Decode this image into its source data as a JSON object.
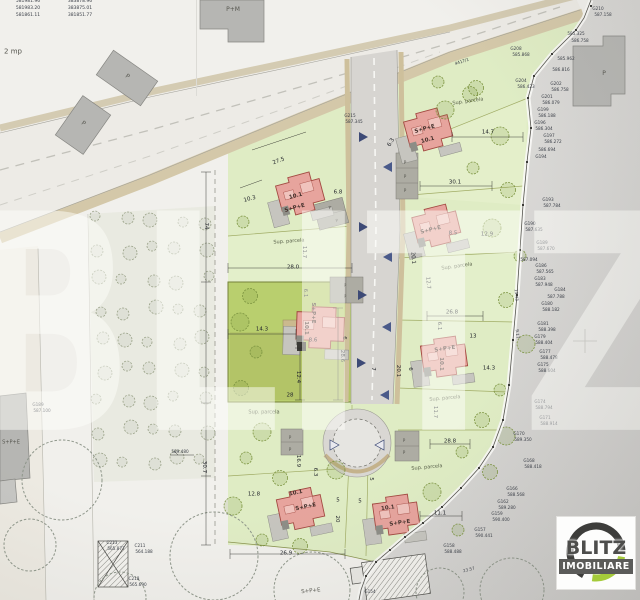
{
  "watermark": {
    "text": "BLITZ"
  },
  "logo": {
    "line1": "BLITZ",
    "line2": "IMOBILIARE",
    "ring_dark": "#3d3d3b",
    "ring_green": "#a5cb3a"
  },
  "colors": {
    "parcel_green": "#dfecc4",
    "selected_parcel": "#b9cf6e",
    "house_pink": "#e7a49d",
    "house_outline": "#a34a42",
    "road_gray": "#d7d5d1",
    "shoulder_tan": "#d4c8a9",
    "blank_gray": "#d5d4d1",
    "arrow_navy": "#3d4a76"
  },
  "labels": [
    {
      "t": "581981.96",
      "x": 28,
      "y": 2,
      "s": 4.5,
      "c": "t"
    },
    {
      "t": "581983.20",
      "x": 28,
      "y": 9,
      "s": 4.5,
      "c": "t"
    },
    {
      "t": "581861.11",
      "x": 28,
      "y": 16,
      "s": 4.5,
      "c": "t"
    },
    {
      "t": "383878.96",
      "x": 80,
      "y": 2,
      "s": 4.5,
      "c": "t"
    },
    {
      "t": "383875.01",
      "x": 80,
      "y": 9,
      "s": 4.5,
      "c": "t"
    },
    {
      "t": "381851.77",
      "x": 80,
      "y": 16,
      "s": 4.5,
      "c": "t"
    },
    {
      "t": "2 mp",
      "x": 13,
      "y": 52,
      "s": 7,
      "c": "g"
    },
    {
      "t": "P+M",
      "x": 233,
      "y": 10,
      "s": 6,
      "c": "g"
    },
    {
      "t": "P",
      "x": 127,
      "y": 77,
      "s": 6,
      "c": "g",
      "r": 35
    },
    {
      "t": "P",
      "x": 83,
      "y": 124,
      "s": 6,
      "c": "g",
      "r": 35
    },
    {
      "t": "P",
      "x": 604,
      "y": 74,
      "s": 6,
      "c": "g"
    },
    {
      "t": "S+P+E",
      "x": 11,
      "y": 443,
      "s": 5,
      "c": "g"
    },
    {
      "t": "S+P+E",
      "x": 311,
      "y": 592,
      "s": 5.5,
      "c": "g",
      "r": -6
    },
    {
      "t": "4417/1",
      "x": 462,
      "y": 62,
      "s": 4.2,
      "c": "t",
      "r": -18
    },
    {
      "t": "G215",
      "x": 350,
      "y": 116,
      "s": 4.2,
      "c": "t"
    },
    {
      "t": "587.345",
      "x": 354,
      "y": 122,
      "s": 4.2,
      "c": "t"
    },
    {
      "t": "10.1",
      "x": 296,
      "y": 197,
      "s": 5.5,
      "c": "h",
      "r": -15
    },
    {
      "t": "S+P+E",
      "x": 295,
      "y": 209,
      "s": 5.5,
      "c": "h",
      "r": -15
    },
    {
      "t": "S+P+E",
      "x": 425,
      "y": 130,
      "s": 5.5,
      "c": "h",
      "r": -15
    },
    {
      "t": "10.1",
      "x": 428,
      "y": 141,
      "s": 5.5,
      "c": "h",
      "r": -15
    },
    {
      "t": "S+P+E",
      "x": 431,
      "y": 231,
      "s": 5.5,
      "c": "h",
      "r": -14
    },
    {
      "t": "8.5",
      "x": 453,
      "y": 234,
      "s": 5.5,
      "c": "d"
    },
    {
      "t": "S+P+E",
      "x": 312,
      "y": 313,
      "s": 5.5,
      "c": "h",
      "r": 90
    },
    {
      "t": "10.1",
      "x": 305,
      "y": 328,
      "s": 5.5,
      "c": "h",
      "r": 90
    },
    {
      "t": "8.6",
      "x": 313,
      "y": 341,
      "s": 5.5,
      "c": "d"
    },
    {
      "t": "S+P+E",
      "x": 445,
      "y": 350,
      "s": 5.5,
      "c": "h",
      "r": -8
    },
    {
      "t": "10.1",
      "x": 440,
      "y": 364,
      "s": 5.5,
      "c": "h",
      "r": 90
    },
    {
      "t": "10.1",
      "x": 296,
      "y": 494,
      "s": 5.5,
      "c": "h",
      "r": -12
    },
    {
      "t": "S+P+E",
      "x": 306,
      "y": 508,
      "s": 5.5,
      "c": "h",
      "r": -12
    },
    {
      "t": "10.1",
      "x": 388,
      "y": 509,
      "s": 5.5,
      "c": "h",
      "r": -8
    },
    {
      "t": "S+P+E",
      "x": 400,
      "y": 524,
      "s": 5.5,
      "c": "h",
      "r": -8
    },
    {
      "t": "Sup. parcela",
      "x": 289,
      "y": 242,
      "s": 5,
      "c": "p",
      "r": -4
    },
    {
      "t": "Sup. parcela",
      "x": 264,
      "y": 413,
      "s": 5,
      "c": "p"
    },
    {
      "t": "Sup. parcela",
      "x": 468,
      "y": 102,
      "s": 5,
      "c": "p",
      "r": -8
    },
    {
      "t": "Sup. parcela",
      "x": 457,
      "y": 267,
      "s": 5,
      "c": "p",
      "r": -8
    },
    {
      "t": "Sup. parcela",
      "x": 445,
      "y": 399,
      "s": 5,
      "c": "p",
      "r": -5
    },
    {
      "t": "Sup. parcela",
      "x": 427,
      "y": 468,
      "s": 5,
      "c": "p",
      "r": -5
    },
    {
      "t": "27.5",
      "x": 279,
      "y": 162,
      "c": "d",
      "r": -20,
      "s": 5.5
    },
    {
      "t": "10.3",
      "x": 250,
      "y": 200,
      "c": "d",
      "r": -15,
      "s": 5.5
    },
    {
      "t": "6.8",
      "x": 338,
      "y": 193,
      "c": "d",
      "s": 5.5
    },
    {
      "t": "11.7",
      "x": 303,
      "y": 252,
      "c": "d",
      "r": 90,
      "s": 5.5
    },
    {
      "t": "28.0",
      "x": 293,
      "y": 268,
      "c": "d",
      "s": 5.5
    },
    {
      "t": "74",
      "x": 205,
      "y": 226,
      "c": "d",
      "r": 90,
      "s": 5.5
    },
    {
      "t": "6.1",
      "x": 304,
      "y": 293,
      "c": "d",
      "r": 90,
      "s": 5.5
    },
    {
      "t": "14.3",
      "x": 262,
      "y": 330,
      "c": "d",
      "s": 5.5
    },
    {
      "t": "6",
      "x": 343,
      "y": 338,
      "c": "d",
      "r": 90,
      "s": 5.5
    },
    {
      "t": "28.6",
      "x": 341,
      "y": 356,
      "c": "d",
      "r": 90,
      "s": 5.5
    },
    {
      "t": "12.4",
      "x": 297,
      "y": 377,
      "c": "d",
      "r": 90,
      "s": 5.5
    },
    {
      "t": "28",
      "x": 290,
      "y": 396,
      "c": "d",
      "s": 5.5
    },
    {
      "t": "7",
      "x": 372,
      "y": 369,
      "c": "d",
      "r": 90,
      "s": 5.5
    },
    {
      "t": "16.9",
      "x": 297,
      "y": 461,
      "c": "d",
      "r": 90,
      "s": 5.5
    },
    {
      "t": "6.3",
      "x": 314,
      "y": 472,
      "c": "d",
      "r": 90,
      "s": 5.5
    },
    {
      "t": "30.7",
      "x": 203,
      "y": 467,
      "c": "d",
      "r": 90,
      "s": 5.5
    },
    {
      "t": "12.8",
      "x": 254,
      "y": 495,
      "c": "d",
      "s": 5.5
    },
    {
      "t": "5",
      "x": 338,
      "y": 501,
      "c": "d",
      "s": 5.5
    },
    {
      "t": "5",
      "x": 360,
      "y": 502,
      "c": "d",
      "s": 5.5
    },
    {
      "t": "20",
      "x": 336,
      "y": 519,
      "c": "d",
      "r": 90,
      "s": 5.5
    },
    {
      "t": "11.1",
      "x": 440,
      "y": 514,
      "c": "d",
      "s": 5.5
    },
    {
      "t": "26.9",
      "x": 286,
      "y": 554,
      "c": "d",
      "s": 5.5
    },
    {
      "t": "6.3",
      "x": 392,
      "y": 143,
      "c": "d",
      "r": -60,
      "s": 5.5
    },
    {
      "t": "14.7",
      "x": 488,
      "y": 133,
      "c": "d",
      "s": 5.5
    },
    {
      "t": "30.1",
      "x": 455,
      "y": 183,
      "c": "d",
      "s": 5.5
    },
    {
      "t": "12.9",
      "x": 487,
      "y": 235,
      "c": "d",
      "s": 5.5
    },
    {
      "t": "20.1",
      "x": 412,
      "y": 258,
      "c": "d",
      "r": 85,
      "s": 5.5
    },
    {
      "t": "12.7",
      "x": 427,
      "y": 283,
      "c": "d",
      "r": 85,
      "s": 5.5
    },
    {
      "t": "26.8",
      "x": 452,
      "y": 313,
      "c": "d",
      "s": 5.5
    },
    {
      "t": "6.1",
      "x": 438,
      "y": 326,
      "c": "d",
      "r": 90,
      "s": 5.5
    },
    {
      "t": "13",
      "x": 473,
      "y": 337,
      "c": "d",
      "s": 5.5
    },
    {
      "t": "20.1",
      "x": 397,
      "y": 371,
      "c": "d",
      "r": 90,
      "s": 5.5
    },
    {
      "t": "6",
      "x": 409,
      "y": 369,
      "c": "d",
      "r": 90,
      "s": 5.5
    },
    {
      "t": "14.3",
      "x": 489,
      "y": 369,
      "c": "d",
      "s": 5.5
    },
    {
      "t": "11.7",
      "x": 434,
      "y": 412,
      "c": "d",
      "r": 90,
      "s": 5.5
    },
    {
      "t": "28.8",
      "x": 450,
      "y": 442,
      "c": "d",
      "s": 5.5
    },
    {
      "t": "5",
      "x": 370,
      "y": 479,
      "c": "d",
      "r": 90,
      "s": 5.5
    },
    {
      "t": "589.480",
      "x": 180,
      "y": 452,
      "s": 4.2,
      "c": "t"
    },
    {
      "t": "C213",
      "x": 112,
      "y": 543,
      "s": 4.2,
      "c": "t"
    },
    {
      "t": "565.877",
      "x": 116,
      "y": 549,
      "s": 4.2,
      "c": "t"
    },
    {
      "t": "C211",
      "x": 140,
      "y": 546,
      "s": 4.2,
      "c": "t"
    },
    {
      "t": "564.188",
      "x": 144,
      "y": 552,
      "s": 4.2,
      "c": "t"
    },
    {
      "t": "C218",
      "x": 134,
      "y": 579,
      "s": 4.2,
      "c": "t"
    },
    {
      "t": "565.690",
      "x": 138,
      "y": 585,
      "s": 4.2,
      "c": "t"
    },
    {
      "t": "G189",
      "x": 38,
      "y": 405,
      "s": 4.2,
      "c": "t"
    },
    {
      "t": "587.100",
      "x": 42,
      "y": 411,
      "s": 4.2,
      "c": "t"
    },
    {
      "t": "G210",
      "x": 598,
      "y": 9,
      "s": 4.2,
      "c": "t"
    },
    {
      "t": "587.158",
      "x": 603,
      "y": 15,
      "s": 4.2,
      "c": "t"
    },
    {
      "t": "585.325",
      "x": 576,
      "y": 34,
      "s": 4.2,
      "c": "t"
    },
    {
      "t": "586.758",
      "x": 580,
      "y": 41,
      "s": 4.2,
      "c": "t"
    },
    {
      "t": "G208",
      "x": 516,
      "y": 49,
      "s": 4.2,
      "c": "t"
    },
    {
      "t": "585.868",
      "x": 521,
      "y": 55,
      "s": 4.2,
      "c": "t"
    },
    {
      "t": "585.962",
      "x": 566,
      "y": 59,
      "s": 4.2,
      "c": "t"
    },
    {
      "t": "586.816",
      "x": 561,
      "y": 70,
      "s": 4.2,
      "c": "t"
    },
    {
      "t": "G204",
      "x": 521,
      "y": 81,
      "s": 4.2,
      "c": "t"
    },
    {
      "t": "586.423",
      "x": 526,
      "y": 87,
      "s": 4.2,
      "c": "t"
    },
    {
      "t": "G202",
      "x": 556,
      "y": 84,
      "s": 4.2,
      "c": "t"
    },
    {
      "t": "586.758",
      "x": 560,
      "y": 90,
      "s": 4.2,
      "c": "t"
    },
    {
      "t": "G201",
      "x": 547,
      "y": 97,
      "s": 4.2,
      "c": "t"
    },
    {
      "t": "586.079",
      "x": 551,
      "y": 103,
      "s": 4.2,
      "c": "t"
    },
    {
      "t": "G199",
      "x": 543,
      "y": 110,
      "s": 4.2,
      "c": "t"
    },
    {
      "t": "586.188",
      "x": 547,
      "y": 116,
      "s": 4.2,
      "c": "t"
    },
    {
      "t": "G196",
      "x": 540,
      "y": 123,
      "s": 4.2,
      "c": "t"
    },
    {
      "t": "586.304",
      "x": 544,
      "y": 129,
      "s": 4.2,
      "c": "t"
    },
    {
      "t": "G197",
      "x": 549,
      "y": 136,
      "s": 4.2,
      "c": "t"
    },
    {
      "t": "586.272",
      "x": 553,
      "y": 142,
      "s": 4.2,
      "c": "t"
    },
    {
      "t": "586.694",
      "x": 547,
      "y": 150,
      "s": 4.2,
      "c": "t"
    },
    {
      "t": "G194",
      "x": 541,
      "y": 157,
      "s": 4.2,
      "c": "t"
    },
    {
      "t": "G193",
      "x": 548,
      "y": 200,
      "s": 4.2,
      "c": "t"
    },
    {
      "t": "587.784",
      "x": 552,
      "y": 206,
      "s": 4.2,
      "c": "t"
    },
    {
      "t": "G190",
      "x": 530,
      "y": 224,
      "s": 4.2,
      "c": "t"
    },
    {
      "t": "587.635",
      "x": 534,
      "y": 230,
      "s": 4.2,
      "c": "t"
    },
    {
      "t": "G189",
      "x": 542,
      "y": 243,
      "s": 4.2,
      "c": "t"
    },
    {
      "t": "587.670",
      "x": 546,
      "y": 249,
      "s": 4.2,
      "c": "t"
    },
    {
      "t": "587.094",
      "x": 529,
      "y": 260,
      "s": 4.2,
      "c": "t"
    },
    {
      "t": "G186",
      "x": 541,
      "y": 266,
      "s": 4.2,
      "c": "t"
    },
    {
      "t": "587.565",
      "x": 545,
      "y": 272,
      "s": 4.2,
      "c": "t"
    },
    {
      "t": "G183",
      "x": 540,
      "y": 279,
      "s": 4.2,
      "c": "t"
    },
    {
      "t": "587.948",
      "x": 544,
      "y": 285,
      "s": 4.2,
      "c": "t"
    },
    {
      "t": "G184",
      "x": 560,
      "y": 290,
      "s": 4.2,
      "c": "t"
    },
    {
      "t": "587.788",
      "x": 556,
      "y": 297,
      "s": 4.2,
      "c": "t"
    },
    {
      "t": "G180",
      "x": 547,
      "y": 304,
      "s": 4.2,
      "c": "t"
    },
    {
      "t": "588.182",
      "x": 551,
      "y": 310,
      "s": 4.2,
      "c": "t"
    },
    {
      "t": "13.43",
      "x": 516,
      "y": 295,
      "r": 85,
      "s": 4.2,
      "c": "t"
    },
    {
      "t": "G181",
      "x": 543,
      "y": 324,
      "s": 4.2,
      "c": "t"
    },
    {
      "t": "588.398",
      "x": 547,
      "y": 330,
      "s": 4.2,
      "c": "t"
    },
    {
      "t": "G179",
      "x": 540,
      "y": 337,
      "s": 4.2,
      "c": "t"
    },
    {
      "t": "588.404",
      "x": 544,
      "y": 343,
      "s": 4.2,
      "c": "t"
    },
    {
      "t": "G177",
      "x": 545,
      "y": 352,
      "s": 4.2,
      "c": "t"
    },
    {
      "t": "588.478",
      "x": 549,
      "y": 358,
      "s": 4.2,
      "c": "t"
    },
    {
      "t": "G175",
      "x": 543,
      "y": 365,
      "s": 4.2,
      "c": "t"
    },
    {
      "t": "588.604",
      "x": 547,
      "y": 371,
      "s": 4.2,
      "c": "t"
    },
    {
      "t": "9.17",
      "x": 517,
      "y": 334,
      "r": 85,
      "s": 4.2,
      "c": "t"
    },
    {
      "t": "G174",
      "x": 540,
      "y": 402,
      "s": 4.2,
      "c": "t"
    },
    {
      "t": "588.794",
      "x": 544,
      "y": 408,
      "s": 4.2,
      "c": "t"
    },
    {
      "t": "G171",
      "x": 545,
      "y": 418,
      "s": 4.2,
      "c": "t"
    },
    {
      "t": "588.914",
      "x": 549,
      "y": 424,
      "s": 4.2,
      "c": "t"
    },
    {
      "t": "G170",
      "x": 519,
      "y": 434,
      "s": 4.2,
      "c": "t"
    },
    {
      "t": "589.350",
      "x": 523,
      "y": 440,
      "s": 4.2,
      "c": "t"
    },
    {
      "t": "G168",
      "x": 529,
      "y": 461,
      "s": 4.2,
      "c": "t"
    },
    {
      "t": "588.418",
      "x": 533,
      "y": 467,
      "s": 4.2,
      "c": "t"
    },
    {
      "t": "G166",
      "x": 512,
      "y": 489,
      "s": 4.2,
      "c": "t"
    },
    {
      "t": "588.568",
      "x": 516,
      "y": 495,
      "s": 4.2,
      "c": "t"
    },
    {
      "t": "G162",
      "x": 503,
      "y": 502,
      "s": 4.2,
      "c": "t"
    },
    {
      "t": "589.280",
      "x": 507,
      "y": 508,
      "s": 4.2,
      "c": "t"
    },
    {
      "t": "G159",
      "x": 497,
      "y": 514,
      "s": 4.2,
      "c": "t"
    },
    {
      "t": "590.400",
      "x": 501,
      "y": 520,
      "s": 4.2,
      "c": "t"
    },
    {
      "t": "G157",
      "x": 480,
      "y": 530,
      "s": 4.2,
      "c": "t"
    },
    {
      "t": "590.441",
      "x": 484,
      "y": 536,
      "s": 4.2,
      "c": "t"
    },
    {
      "t": "G158",
      "x": 449,
      "y": 546,
      "s": 4.2,
      "c": "t"
    },
    {
      "t": "588.488",
      "x": 453,
      "y": 552,
      "s": 4.2,
      "c": "t"
    },
    {
      "t": "23.57",
      "x": 469,
      "y": 570,
      "s": 4.2,
      "c": "t",
      "r": -15
    },
    {
      "t": "G154",
      "x": 370,
      "y": 592,
      "s": 4.2,
      "c": "t"
    },
    {
      "t": "P",
      "x": 405,
      "y": 163,
      "s": 4.2,
      "c": "g"
    },
    {
      "t": "P",
      "x": 405,
      "y": 177,
      "s": 4.2,
      "c": "g"
    },
    {
      "t": "P",
      "x": 405,
      "y": 191,
      "s": 4.2,
      "c": "g"
    },
    {
      "t": "P",
      "x": 330,
      "y": 208,
      "s": 4.2,
      "c": "g",
      "r": -15
    },
    {
      "t": "P",
      "x": 337,
      "y": 221,
      "s": 4.2,
      "c": "g",
      "r": -15
    },
    {
      "t": "P",
      "x": 345,
      "y": 286,
      "s": 4.2,
      "c": "g"
    },
    {
      "t": "P",
      "x": 345,
      "y": 297,
      "s": 4.2,
      "c": "g"
    },
    {
      "t": "P",
      "x": 290,
      "y": 438,
      "s": 4.2,
      "c": "g"
    },
    {
      "t": "P",
      "x": 290,
      "y": 450,
      "s": 4.2,
      "c": "g"
    },
    {
      "t": "P",
      "x": 404,
      "y": 441,
      "s": 4.2,
      "c": "g"
    },
    {
      "t": "P",
      "x": 404,
      "y": 453,
      "s": 4.2,
      "c": "g"
    }
  ]
}
